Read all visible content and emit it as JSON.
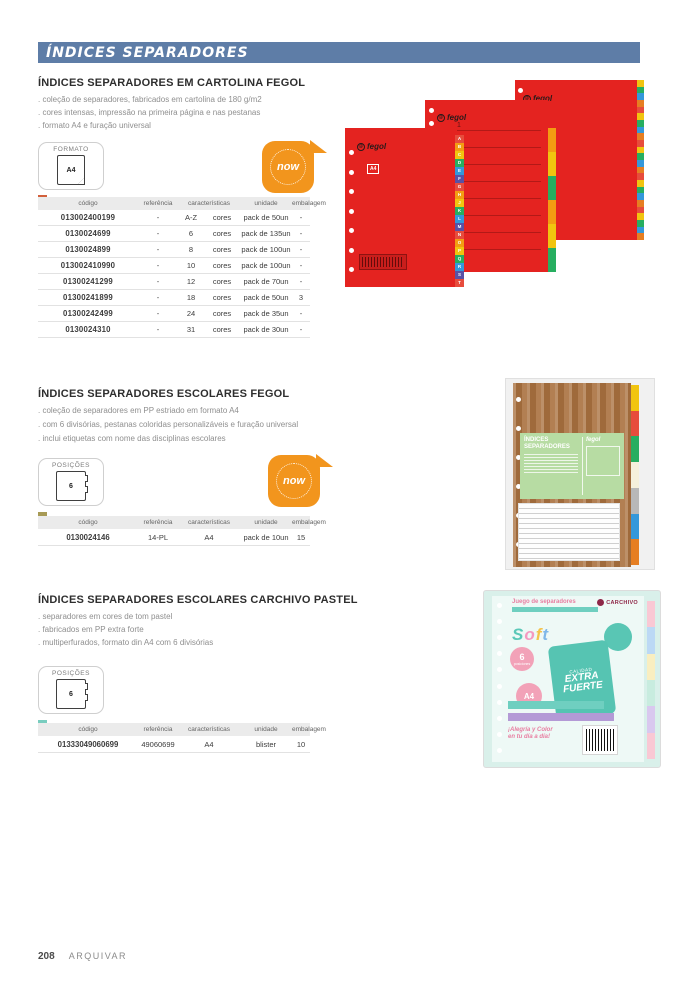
{
  "header": {
    "title": "ÍNDICES SEPARADORES"
  },
  "footer": {
    "page_number": "208",
    "section_label": "ARQUIVAR"
  },
  "table_headers": {
    "codigo": "código",
    "referencia": "referência",
    "caracteristicas": "características",
    "unidade": "unidade",
    "embalagem": "embalagem"
  },
  "badges": {
    "now_label": "now",
    "formato_label": "FORMATO",
    "formato_value": "A4",
    "posicoes_label": "POSIÇÕES",
    "posicoes_value": "6"
  },
  "sections": [
    {
      "title": "ÍNDICES SEPARADORES EM CARTOLINA FEGOL",
      "bullets": [
        "coleção de separadores, fabricados em cartolina de 180 g/m2",
        "cores intensas, impressão na primeira página e nas pestanas",
        "formato A4 e furação universal"
      ],
      "swatch_color": "#d2603c",
      "rows": [
        {
          "codigo": "013002400199",
          "referencia": "-",
          "carac1": "A-Z",
          "carac2": "cores",
          "unidade": "pack de 50un",
          "embalagem": "-"
        },
        {
          "codigo": "0130024699",
          "referencia": "-",
          "carac1": "6",
          "carac2": "cores",
          "unidade": "pack de 135un",
          "embalagem": "-"
        },
        {
          "codigo": "0130024899",
          "referencia": "-",
          "carac1": "8",
          "carac2": "cores",
          "unidade": "pack de 100un",
          "embalagem": "-"
        },
        {
          "codigo": "013002410990",
          "referencia": "-",
          "carac1": "10",
          "carac2": "cores",
          "unidade": "pack de 100un",
          "embalagem": "-"
        },
        {
          "codigo": "01300241299",
          "referencia": "-",
          "carac1": "12",
          "carac2": "cores",
          "unidade": "pack de 70un",
          "embalagem": "-"
        },
        {
          "codigo": "01300241899",
          "referencia": "-",
          "carac1": "18",
          "carac2": "cores",
          "unidade": "pack de 50un",
          "embalagem": "3"
        },
        {
          "codigo": "01300242499",
          "referencia": "-",
          "carac1": "24",
          "carac2": "cores",
          "unidade": "pack de 35un",
          "embalagem": "-"
        },
        {
          "codigo": "0130024310",
          "referencia": "-",
          "carac1": "31",
          "carac2": "cores",
          "unidade": "pack de 30un",
          "embalagem": "-"
        }
      ]
    },
    {
      "title": "ÍNDICES SEPARADORES ESCOLARES FEGOL",
      "bullets": [
        "coleção de separadores em PP estriado em formato A4",
        "com 6 divisórias, pestanas coloridas personalizáveis e furação universal",
        "inclui etiquetas com nome das disciplinas escolares"
      ],
      "swatch_color": "#a79a55",
      "rows": [
        {
          "codigo": "0130024146",
          "referencia": "14-PL",
          "caracteristicas": "A4",
          "unidade": "pack de 10un",
          "embalagem": "15"
        }
      ]
    },
    {
      "title": "ÍNDICES SEPARADORES ESCOLARES CARCHIVO PASTEL",
      "bullets": [
        "separadores em cores de tom pastel",
        "fabricados em PP extra forte",
        "multiperfurados, formato din A4 com 6 divisórias"
      ],
      "swatch_color": "#79cdbf",
      "rows": [
        {
          "codigo": "01333049060699",
          "referencia": "49060699",
          "caracteristicas": "A4",
          "unidade": "blister",
          "embalagem": "10"
        }
      ]
    }
  ],
  "art": {
    "fegol_logo": "fegol",
    "fegol_at": "@",
    "a4_mark": "A4",
    "index_numbers": [
      "1",
      "2",
      "3",
      "4",
      "5",
      "6",
      "7",
      "8"
    ],
    "az_tabs": [
      {
        "label": "A",
        "bg": "#e74c3c"
      },
      {
        "label": "B",
        "bg": "#f39c12"
      },
      {
        "label": "C",
        "bg": "#f1c40f"
      },
      {
        "label": "D",
        "bg": "#27ae60"
      },
      {
        "label": "E",
        "bg": "#3498db"
      },
      {
        "label": "F",
        "bg": "#5a51a5"
      },
      {
        "label": "G",
        "bg": "#e74c3c"
      },
      {
        "label": "H",
        "bg": "#f39c12"
      },
      {
        "label": "J",
        "bg": "#f1c40f"
      },
      {
        "label": "K",
        "bg": "#27ae60"
      },
      {
        "label": "L",
        "bg": "#3498db"
      },
      {
        "label": "M",
        "bg": "#5a51a5"
      },
      {
        "label": "N",
        "bg": "#e74c3c"
      },
      {
        "label": "O",
        "bg": "#f39c12"
      },
      {
        "label": "P",
        "bg": "#f1c40f"
      },
      {
        "label": "Q",
        "bg": "#27ae60"
      },
      {
        "label": "R",
        "bg": "#3498db"
      },
      {
        "label": "S",
        "bg": "#5a51a5"
      },
      {
        "label": "T",
        "bg": "#e74c3c"
      }
    ],
    "small_tabs": [
      {
        "bg": "#f1c40f"
      },
      {
        "bg": "#27ae60"
      },
      {
        "bg": "#3498db"
      },
      {
        "bg": "#e67e22"
      },
      {
        "bg": "#e74c3c"
      },
      {
        "bg": "#f1c40f"
      },
      {
        "bg": "#27ae60"
      },
      {
        "bg": "#3498db"
      },
      {
        "bg": "#e67e22"
      },
      {
        "bg": "#e74c3c"
      },
      {
        "bg": "#f1c40f"
      },
      {
        "bg": "#27ae60"
      },
      {
        "bg": "#3498db"
      },
      {
        "bg": "#e67e22"
      },
      {
        "bg": "#e74c3c"
      },
      {
        "bg": "#f1c40f"
      },
      {
        "bg": "#27ae60"
      },
      {
        "bg": "#3498db"
      },
      {
        "bg": "#e67e22"
      },
      {
        "bg": "#e74c3c"
      },
      {
        "bg": "#f1c40f"
      },
      {
        "bg": "#27ae60"
      },
      {
        "bg": "#3498db"
      },
      {
        "bg": "#e67e22"
      }
    ],
    "big_tabs": [
      {
        "bg": "#f39c12"
      },
      {
        "bg": "#f1c40f"
      },
      {
        "bg": "#27ae60"
      },
      {
        "bg": "#f39c12"
      },
      {
        "bg": "#f1c40f"
      },
      {
        "bg": "#27ae60"
      }
    ],
    "brown_tabs": [
      {
        "bg": "#f1c40f"
      },
      {
        "bg": "#e74c3c"
      },
      {
        "bg": "#27ae60"
      },
      {
        "bg": "#f5f0dc"
      },
      {
        "bg": "#b8b8b8"
      },
      {
        "bg": "#3498db"
      },
      {
        "bg": "#e67e22"
      }
    ],
    "pastel_tabs": [
      {
        "bg": "#f9c8d4"
      },
      {
        "bg": "#bcd9f5"
      },
      {
        "bg": "#f9eec0"
      },
      {
        "bg": "#c8ecdf"
      },
      {
        "bg": "#d9c8ef"
      },
      {
        "bg": "#f9c8d4"
      }
    ],
    "holes7": [
      {},
      {},
      {},
      {},
      {},
      {},
      {}
    ],
    "holes6": [
      {},
      {},
      {},
      {},
      {},
      {}
    ],
    "holes10": [
      {},
      {},
      {},
      {},
      {},
      {},
      {},
      {},
      {},
      {}
    ],
    "holes2": [
      {},
      {}
    ],
    "escolares_label": {
      "line1": "ÍNDICES",
      "line2": "SEPARADORES"
    },
    "pastel": {
      "brand": "CARCHIVO",
      "header_title": "Juego de separadores",
      "soft_letters": [
        {
          "label": "S",
          "color": "#5bc8b8"
        },
        {
          "label": "o",
          "color": "#f49ac1"
        },
        {
          "label": "f",
          "color": "#f4c34b"
        },
        {
          "label": "t",
          "color": "#7fb7e8"
        }
      ],
      "positions_value": "6",
      "positions_caption": "posiciones",
      "quality_prefix": "CALIDAD",
      "quality_line1": "EXTRA",
      "quality_line2": "FUERTE",
      "size_value": "A4",
      "tagline_line1": "¡Alegría y Color",
      "tagline_line2": "en tu día a día!"
    }
  }
}
